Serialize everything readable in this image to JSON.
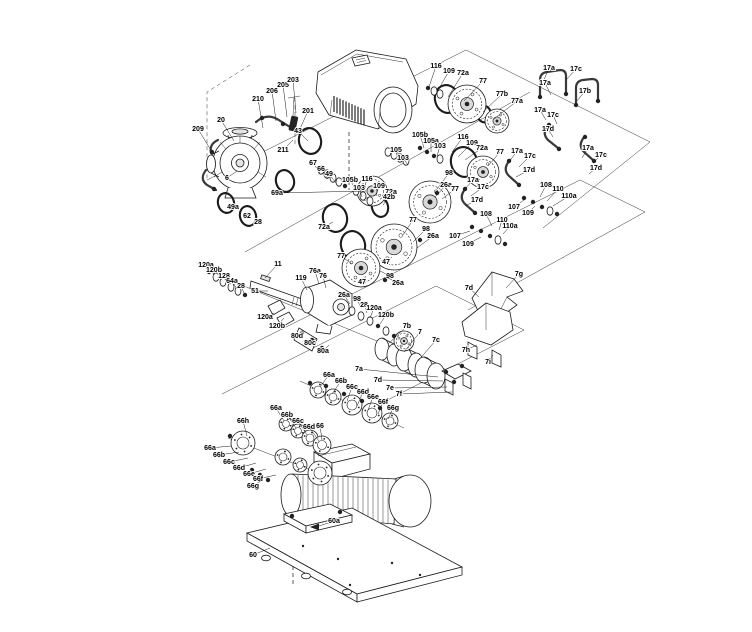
{
  "figure": {
    "type": "exploded-parts-diagram",
    "background": "#ffffff",
    "line_color": "#1b1b1b",
    "label_color": "#000000"
  },
  "callouts": [
    [
      "209",
      198,
      131,
      212,
      152
    ],
    [
      "20",
      221,
      122,
      234,
      141
    ],
    [
      "210",
      258,
      101,
      263,
      128
    ],
    [
      "206",
      272,
      93,
      276,
      121
    ],
    [
      "205",
      283,
      87,
      287,
      117
    ],
    [
      "203",
      293,
      82,
      296,
      113
    ],
    [
      "201",
      308,
      113,
      299,
      131
    ],
    [
      "211",
      283,
      152,
      293,
      140
    ],
    [
      "6",
      227,
      180,
      237,
      171
    ],
    [
      "49a",
      233,
      209,
      228,
      204
    ],
    [
      "62",
      247,
      218,
      247,
      214
    ],
    [
      "28",
      258,
      224,
      254,
      211
    ],
    [
      "43",
      298,
      133,
      308,
      141
    ],
    [
      "67",
      313,
      165,
      320,
      173
    ],
    [
      "66",
      321,
      171,
      328,
      179
    ],
    [
      "49",
      329,
      176,
      336,
      183
    ],
    [
      "69a",
      277,
      195,
      366,
      191
    ],
    [
      "116",
      436,
      68,
      429,
      87
    ],
    [
      "109",
      449,
      73,
      437,
      92
    ],
    [
      "72a",
      463,
      75,
      448,
      97
    ],
    [
      "77",
      483,
      83,
      464,
      101
    ],
    [
      "77b",
      502,
      96,
      483,
      112
    ],
    [
      "77a",
      517,
      103,
      494,
      119
    ],
    [
      "17a",
      549,
      70,
      543,
      82
    ],
    [
      "17c",
      576,
      71,
      566,
      80
    ],
    [
      "17a",
      545,
      85,
      551,
      95
    ],
    [
      "17b",
      585,
      93,
      577,
      101
    ],
    [
      "17a",
      540,
      112,
      546,
      120
    ],
    [
      "17c",
      553,
      117,
      557,
      124
    ],
    [
      "17d",
      548,
      131,
      553,
      137
    ],
    [
      "17a",
      588,
      150,
      582,
      158
    ],
    [
      "17c",
      601,
      157,
      593,
      163
    ],
    [
      "17d",
      596,
      170,
      589,
      174
    ],
    [
      "105b",
      420,
      137,
      424,
      148
    ],
    [
      "105a",
      431,
      143,
      431,
      152
    ],
    [
      "103",
      440,
      148,
      437,
      156
    ],
    [
      "116",
      463,
      139,
      452,
      152
    ],
    [
      "109",
      472,
      145,
      458,
      157
    ],
    [
      "72a",
      482,
      150,
      465,
      160
    ],
    [
      "77",
      500,
      154,
      488,
      166
    ],
    [
      "105",
      396,
      152,
      402,
      159
    ],
    [
      "103",
      403,
      160,
      408,
      165
    ],
    [
      "105b",
      350,
      182,
      356,
      190
    ],
    [
      "116",
      367,
      181,
      364,
      189
    ],
    [
      "103",
      359,
      190,
      362,
      197
    ],
    [
      "109",
      379,
      188,
      376,
      196
    ],
    [
      "72a",
      391,
      194,
      384,
      202
    ],
    [
      "72a",
      324,
      229,
      333,
      222
    ],
    [
      "42b",
      389,
      199,
      383,
      205
    ],
    [
      "98",
      449,
      175,
      437,
      189
    ],
    [
      "26a",
      446,
      187,
      435,
      197
    ],
    [
      "77",
      455,
      191,
      442,
      199
    ],
    [
      "77",
      413,
      222,
      403,
      235
    ],
    [
      "98",
      426,
      231,
      413,
      242
    ],
    [
      "26a",
      433,
      238,
      417,
      248
    ],
    [
      "47",
      386,
      264,
      392,
      257
    ],
    [
      "77",
      341,
      258,
      352,
      264
    ],
    [
      "98",
      390,
      278,
      380,
      271
    ],
    [
      "26a",
      398,
      285,
      386,
      277
    ],
    [
      "47",
      362,
      284,
      366,
      276
    ],
    [
      "108",
      486,
      216,
      492,
      226
    ],
    [
      "110",
      502,
      222,
      499,
      230
    ],
    [
      "110a",
      510,
      228,
      503,
      234
    ],
    [
      "107",
      455,
      238,
      470,
      231
    ],
    [
      "109",
      468,
      246,
      481,
      237
    ],
    [
      "108",
      546,
      187,
      540,
      197
    ],
    [
      "110",
      558,
      191,
      547,
      201
    ],
    [
      "110a",
      569,
      198,
      553,
      206
    ],
    [
      "107",
      514,
      209,
      524,
      200
    ],
    [
      "109",
      528,
      215,
      535,
      206
    ],
    [
      "17a",
      517,
      153,
      509,
      162
    ],
    [
      "17c",
      530,
      158,
      519,
      167
    ],
    [
      "17d",
      529,
      172,
      516,
      177
    ],
    [
      "17a",
      473,
      182,
      464,
      190
    ],
    [
      "17c",
      483,
      189,
      471,
      196
    ],
    [
      "17d",
      477,
      202,
      465,
      206
    ],
    [
      "120a",
      206,
      267,
      215,
      275
    ],
    [
      "120b",
      214,
      272,
      222,
      280
    ],
    [
      "128",
      224,
      278,
      229,
      284
    ],
    [
      "64a",
      232,
      283,
      237,
      289
    ],
    [
      "28",
      241,
      288,
      244,
      293
    ],
    [
      "11",
      278,
      266,
      265,
      278
    ],
    [
      "51",
      255,
      293,
      268,
      291
    ],
    [
      "119",
      301,
      280,
      307,
      290
    ],
    [
      "76a",
      315,
      273,
      319,
      284
    ],
    [
      "76",
      323,
      278,
      326,
      288
    ],
    [
      "120a",
      265,
      319,
      274,
      313
    ],
    [
      "120b",
      277,
      328,
      284,
      318
    ],
    [
      "80d",
      297,
      338,
      304,
      331
    ],
    [
      "80c",
      310,
      345,
      317,
      338
    ],
    [
      "80a",
      323,
      353,
      329,
      345
    ],
    [
      "26a",
      344,
      297,
      350,
      304
    ],
    [
      "98",
      357,
      301,
      361,
      308
    ],
    [
      "28",
      364,
      307,
      367,
      313
    ],
    [
      "120a",
      374,
      310,
      370,
      318
    ],
    [
      "120b",
      386,
      317,
      380,
      324
    ],
    [
      "7b",
      407,
      328,
      388,
      344
    ],
    [
      "7",
      420,
      334,
      404,
      352
    ],
    [
      "7c",
      436,
      342,
      418,
      361
    ],
    [
      "7a",
      359,
      371,
      438,
      377
    ],
    [
      "7d",
      378,
      382,
      443,
      381
    ],
    [
      "7e",
      390,
      390,
      447,
      387
    ],
    [
      "7f",
      399,
      396,
      452,
      392
    ],
    [
      "7g",
      519,
      276,
      506,
      288
    ],
    [
      "7d",
      469,
      290,
      479,
      297
    ],
    [
      "7h",
      466,
      352,
      477,
      345
    ],
    [
      "7i",
      488,
      364,
      493,
      355
    ],
    [
      "66a",
      329,
      377,
      320,
      387
    ],
    [
      "66b",
      341,
      383,
      332,
      394
    ],
    [
      "66c",
      352,
      389,
      347,
      401
    ],
    [
      "66d",
      363,
      394,
      357,
      406
    ],
    [
      "66e",
      373,
      399,
      368,
      410
    ],
    [
      "66f",
      383,
      404,
      378,
      414
    ],
    [
      "66g",
      393,
      410,
      388,
      419
    ],
    [
      "66a",
      276,
      410,
      284,
      421
    ],
    [
      "66b",
      287,
      417,
      296,
      428
    ],
    [
      "66c",
      298,
      423,
      307,
      435
    ],
    [
      "66d",
      309,
      429,
      319,
      441
    ],
    [
      "66a",
      210,
      450,
      231,
      446
    ],
    [
      "66b",
      219,
      457,
      239,
      452
    ],
    [
      "66c",
      229,
      464,
      248,
      458
    ],
    [
      "66d",
      239,
      470,
      256,
      463
    ],
    [
      "66e",
      249,
      476,
      266,
      469
    ],
    [
      "66f",
      258,
      481,
      276,
      475
    ],
    [
      "66g",
      253,
      488,
      262,
      480
    ],
    [
      "66h",
      243,
      423,
      247,
      436
    ],
    [
      "66",
      320,
      428,
      322,
      440
    ],
    [
      "60a",
      334,
      523,
      316,
      527
    ],
    [
      "60",
      253,
      557,
      270,
      548
    ]
  ]
}
